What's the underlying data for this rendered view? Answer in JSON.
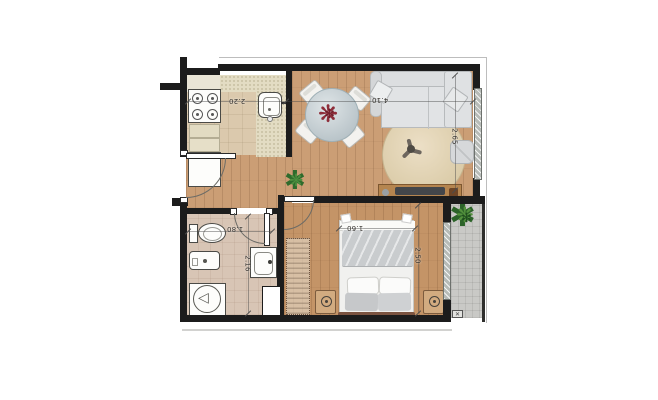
{
  "plan": {
    "type": "apartment-floor-plan",
    "dims": [
      {
        "name": "kitchen-width",
        "value": "2.20",
        "orientation": "horizontal-flipped"
      },
      {
        "name": "living-width",
        "value": "4.10",
        "orientation": "horizontal-flipped"
      },
      {
        "name": "living-depth",
        "value": "2.65",
        "orientation": "vertical"
      },
      {
        "name": "bathroom-width",
        "value": "1.80",
        "orientation": "horizontal-flipped"
      },
      {
        "name": "bathroom-depth",
        "value": "2.16",
        "orientation": "vertical"
      },
      {
        "name": "bed-width",
        "value": "1.60",
        "orientation": "horizontal-flipped"
      },
      {
        "name": "bedroom-depth",
        "value": "2.50",
        "orientation": "vertical"
      }
    ],
    "symbols": {
      "flower_glyph": "❋",
      "plant_glyph_a": "✱",
      "plant_glyph_b": "❋",
      "drain_glyph": "✕",
      "shower_glyph": "◁"
    },
    "colors": {
      "wall": "#1c1c1c",
      "wood_floor": "#cb9e75",
      "kitchen_tile": "#dbc9ad",
      "bath_tile": "#d8c5b5",
      "balcony_tile": "#c9c9c6",
      "rug": "#e3d6bb",
      "sofa": "#dcdee0",
      "flower_accent": "#8e2d3a",
      "plant_green": "#2f6b2c",
      "headboard": "#7b5340"
    }
  }
}
